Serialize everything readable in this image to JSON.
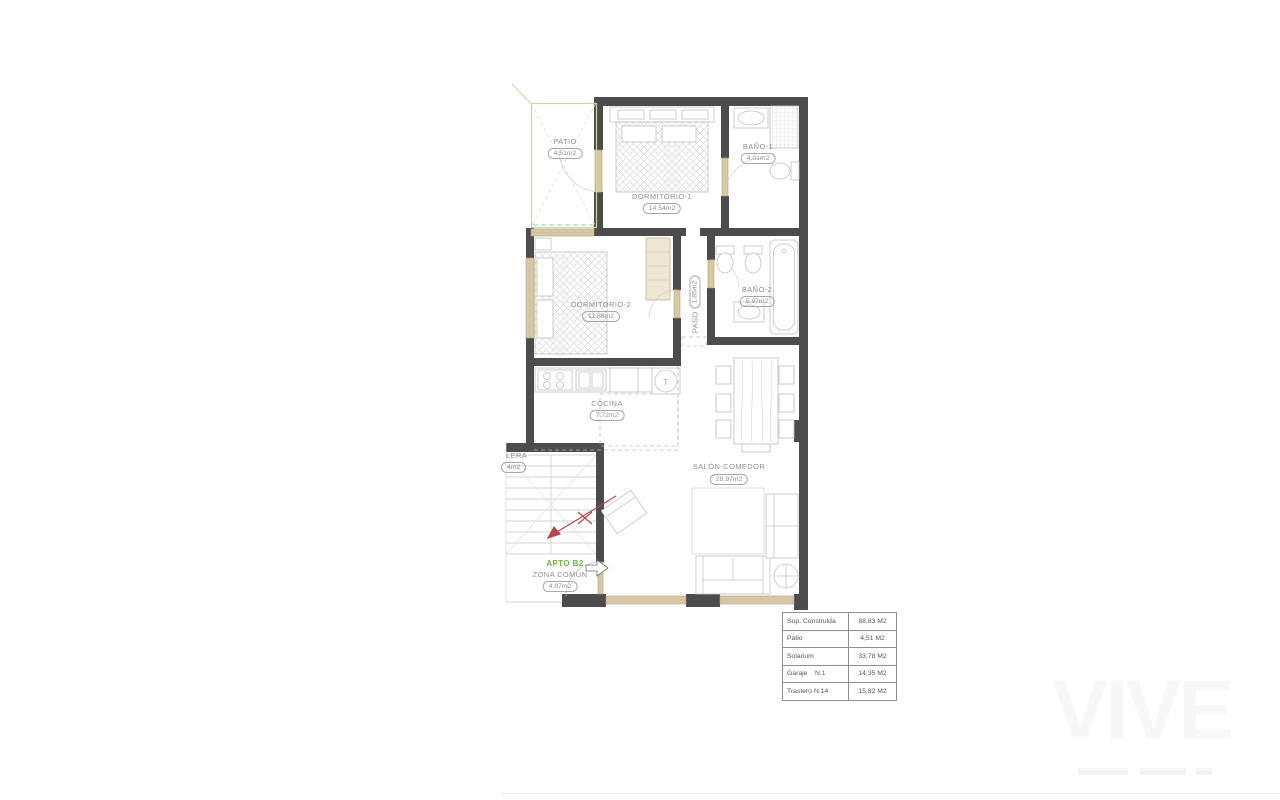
{
  "rooms": {
    "patio": {
      "label": "PATIO",
      "area": "4.51m2"
    },
    "dormitorio1": {
      "label": "DORMITORIO-1",
      "area": "14.54m2"
    },
    "bano1": {
      "label": "BAÑO-1",
      "area": "4.01m2"
    },
    "dormitorio2": {
      "label": "DORMITORIO-2",
      "area": "11.88m2"
    },
    "paso": {
      "label": "PASO",
      "area": "1.85m2"
    },
    "bano2": {
      "label": "BAÑO-2",
      "area": "5.97m2"
    },
    "cocina": {
      "label": "COCINA",
      "area": "7.72m2"
    },
    "salon": {
      "label": "SALÓN-COMEDOR",
      "area": "28.97m2"
    },
    "escalera": {
      "label": "LERA",
      "area": "4m2"
    },
    "zona_comun": {
      "label": "ZONA COMÚN",
      "area": "4.87m2"
    }
  },
  "annotations": {
    "apartment_tag": "APTO B2",
    "water_heater": "T"
  },
  "summary_table": {
    "rows": [
      {
        "label": "Sup. Construida",
        "value": "88,83 M2"
      },
      {
        "label": "Patio",
        "value": "4,51 M2"
      },
      {
        "label": "Solarium",
        "value": "33,78 M2"
      },
      {
        "label": "Garaje    N.1",
        "value": "14,35 M2"
      },
      {
        "label": "Trastero N.14",
        "value": "15,82 M2"
      }
    ]
  },
  "watermark": {
    "text": "VIVE"
  },
  "colors": {
    "wall": "#4c4c4e",
    "furniture_line": "#c0c0c0",
    "carpentry_beige": "#d9c8a4",
    "patio_green": "#ccd79c",
    "label_gray": "#8f8f8f",
    "apto_green": "#6fb43f",
    "stairs_arrow_red": "#b5494d",
    "pool_dash_cyan": "#7fd0dc"
  }
}
